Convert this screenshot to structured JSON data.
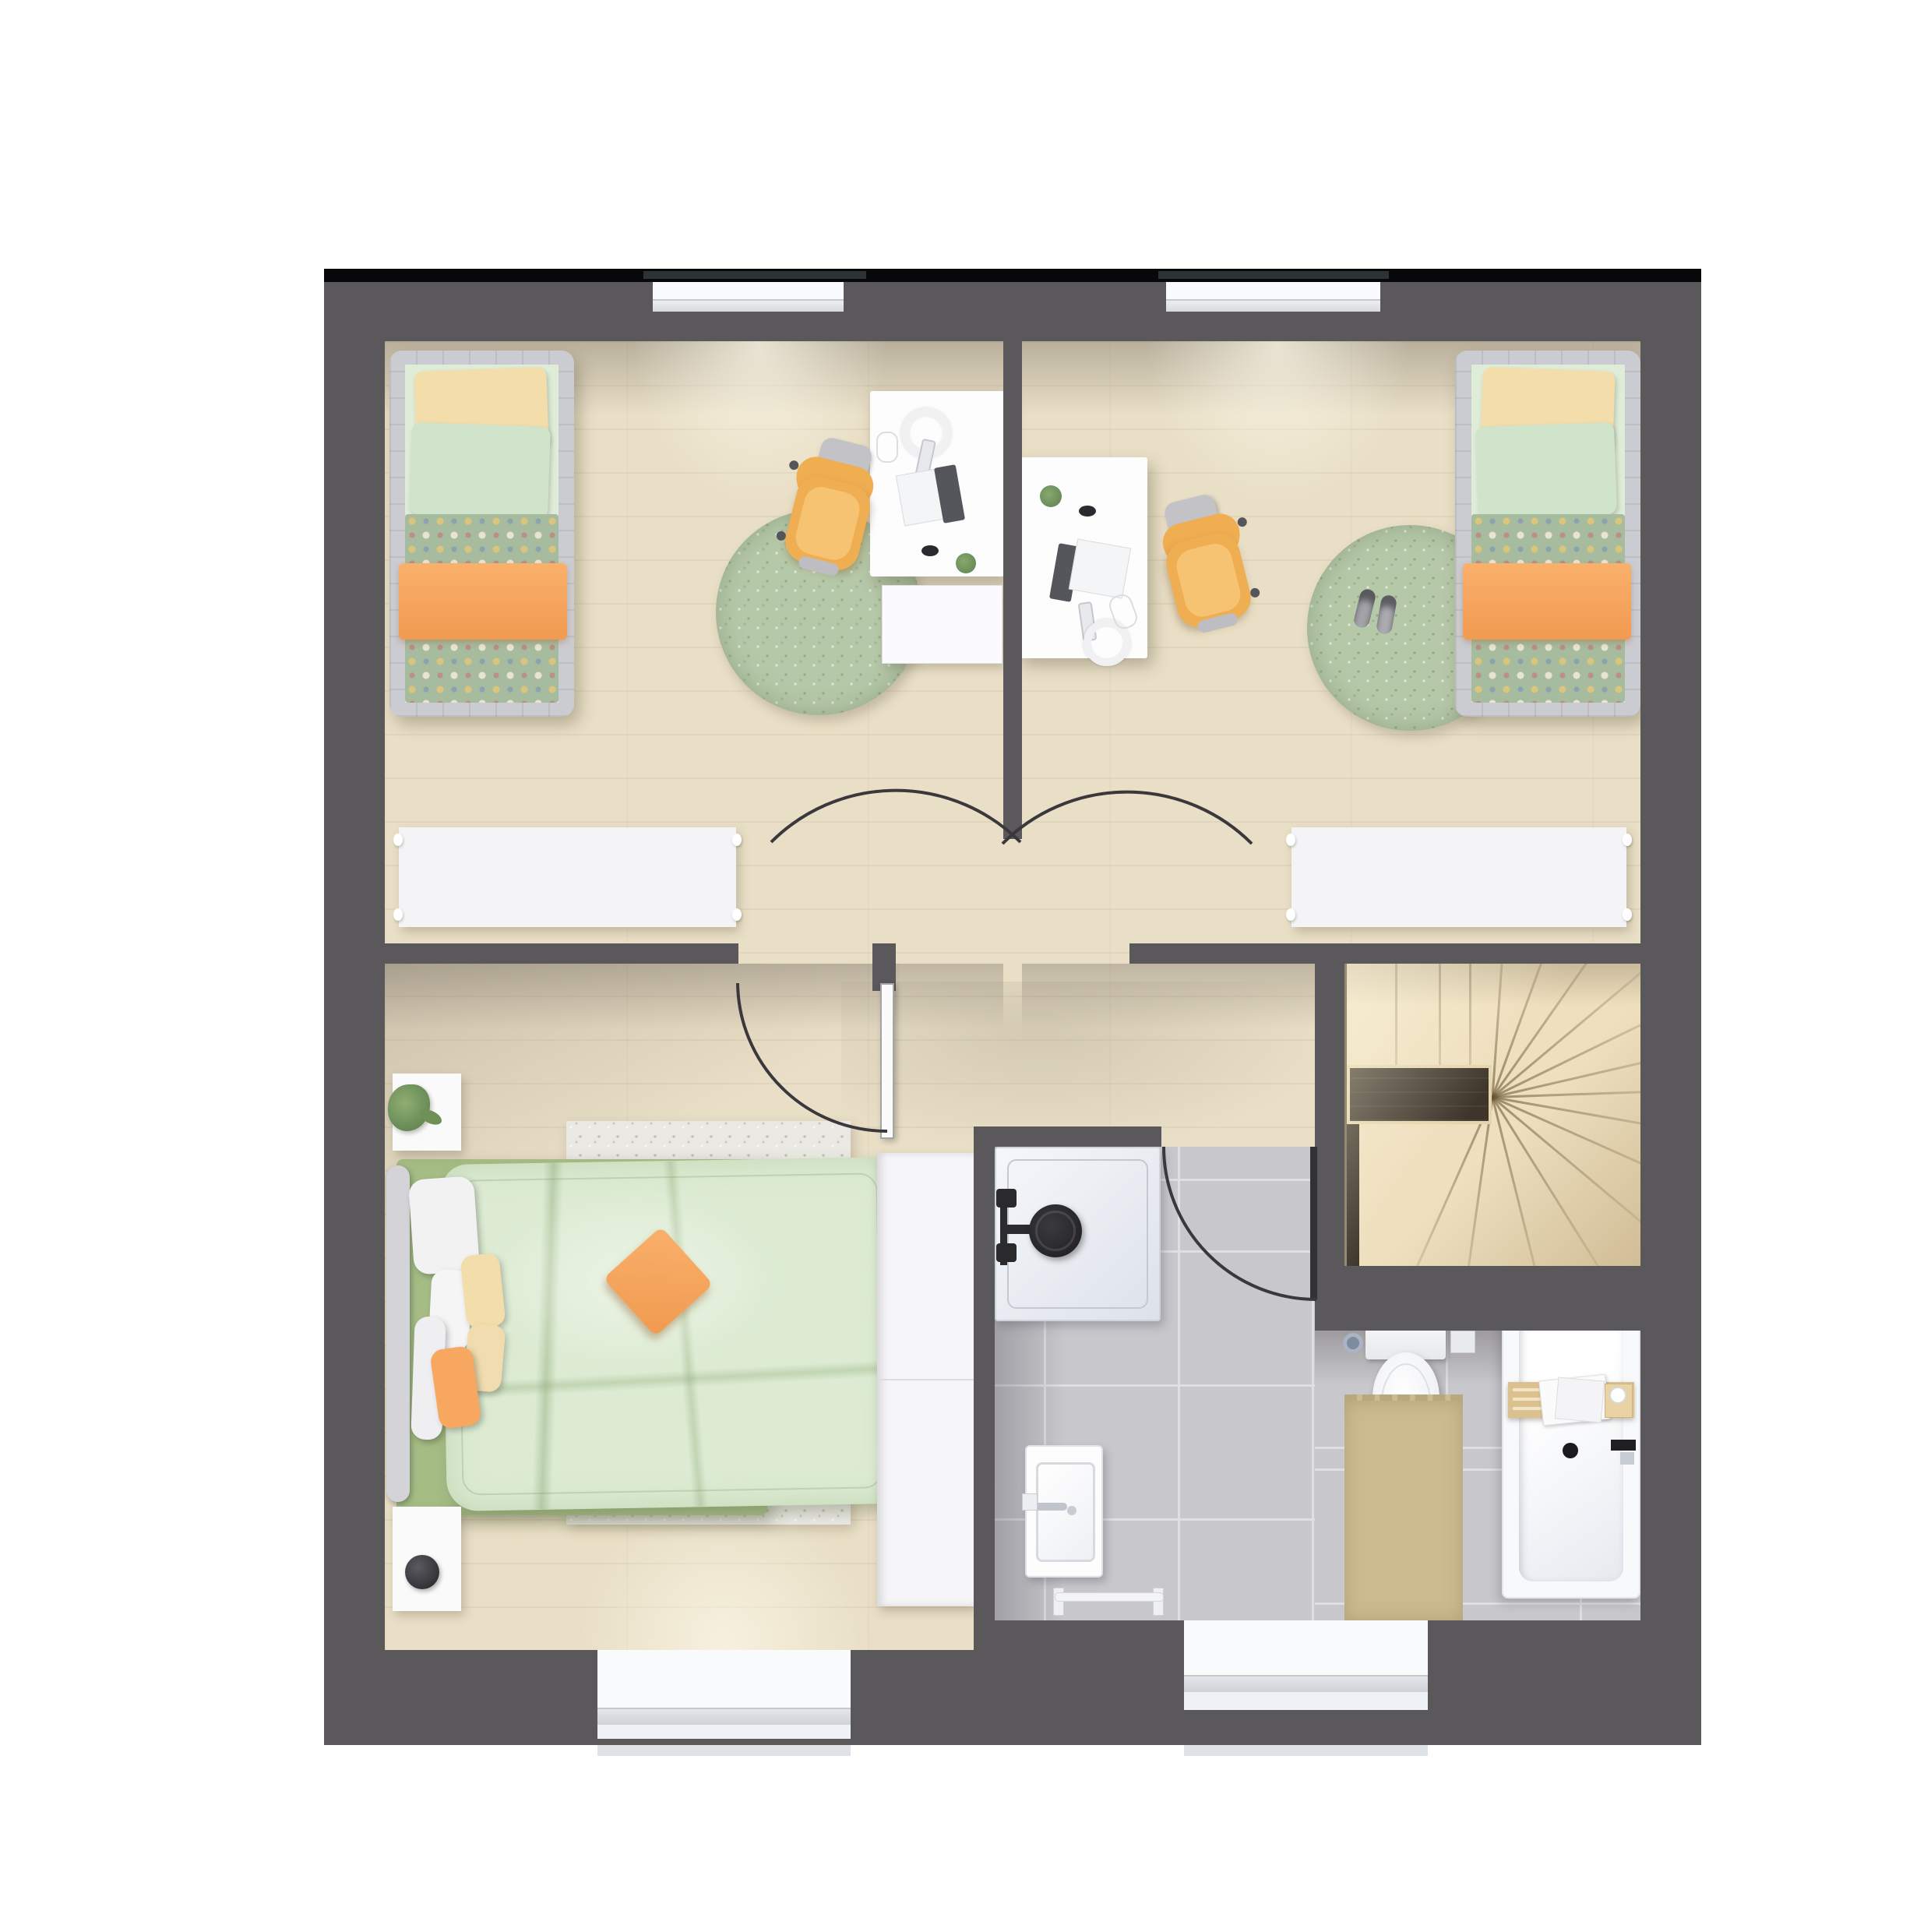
{
  "image_type": "architectural floor plan, top-down 3D render, no text labels",
  "floor_shown": "upper floor of a small house",
  "plan_colors": {
    "wall": "#5a585b",
    "top_outline": "#08080b",
    "shutter_box": "#2d3335",
    "wood_floor": "#e9dfc6",
    "tile_floor": "#c8c7cb",
    "rug_green": "#b5c8a8",
    "blanket_dotted_green": "#a7bb9e",
    "accent_orange": "#f7a75f",
    "chair_yellow": "#f0ae53",
    "duvet_green": "#dcebd2",
    "bed_base_green": "#a5bd85",
    "stairs": "#eedfbe",
    "stair_landing_dark": "#3e362b",
    "sanitary_white": "#f7f9fb",
    "bath_mat_beige": "#ccba90",
    "shower_fitting_black": "#2c2c30",
    "door_arc": "#3a383c"
  },
  "rooms": [
    {
      "id": "kids-bedroom-left",
      "furniture": [
        "single-bed-green-orange-bedding",
        "white-desk-with-laptop-headphones",
        "yellow-swivel-chair",
        "white-drawer-unit",
        "round-green-rug",
        "white-sideboard"
      ]
    },
    {
      "id": "kids-bedroom-right",
      "furniture": [
        "single-bed-green-orange-bedding",
        "white-desk-with-laptop-headphones",
        "yellow-swivel-chair",
        "round-green-rug",
        "gray-slippers",
        "white-sideboard"
      ]
    },
    {
      "id": "master-bedroom",
      "furniture": [
        "double-bed-green-duvet",
        "orange-cushion",
        "white-area-rug",
        "nightstand-with-plant",
        "nightstand-with-speaker",
        "white-wardrobe"
      ]
    },
    {
      "id": "bathroom",
      "furniture": [
        "shower-with-black-fitting",
        "washbasin",
        "toilet",
        "toilet-brush",
        "toilet-paper-holder",
        "beige-bath-mat",
        "bathtub-with-wooden-caddy",
        "towel-rail"
      ]
    },
    {
      "id": "hallway",
      "furniture": []
    },
    {
      "id": "stairwell",
      "furniture": [
        "winder-staircase",
        "dark-wood-landing"
      ]
    }
  ],
  "openings": {
    "windows_top_wall": 2,
    "windows_bottom_wall": 2,
    "doors": [
      "kids-left-door-arc",
      "kids-right-door-arc",
      "master-door-open-leaf",
      "bathroom-door-open-leaf"
    ]
  }
}
